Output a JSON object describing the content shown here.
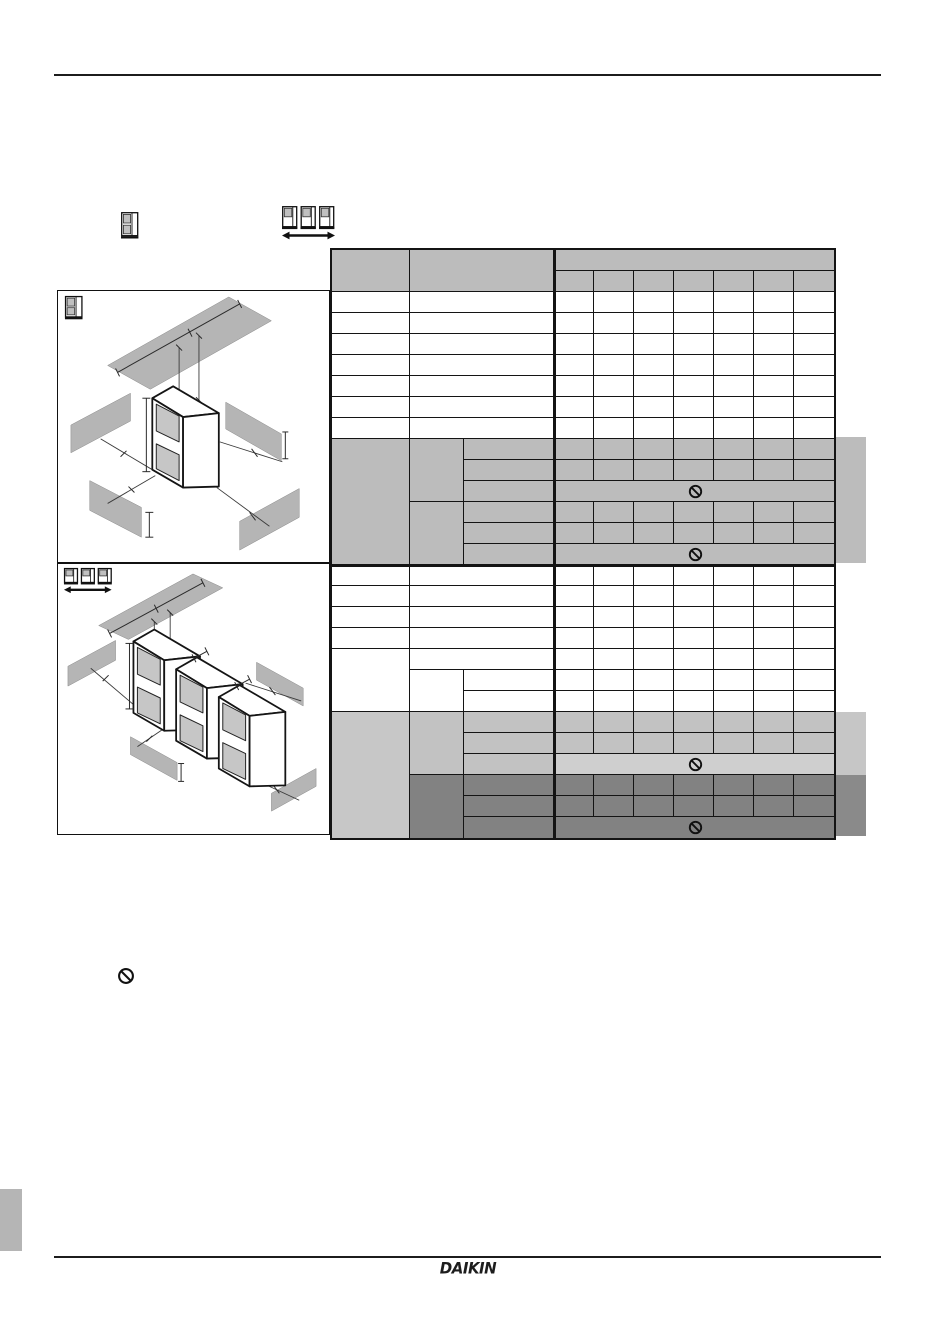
{
  "page": {
    "logo": "DAIKIN"
  },
  "legend": {
    "single_unit_icon": "single-outdoor-unit-front-view",
    "unit_row_icon": "three-outdoor-units-in-row-with-width-arrow"
  },
  "figure": {
    "block1": {
      "diagram": "isometric single outdoor unit with four surrounding walls and ceiling plane"
    },
    "block2": {
      "diagram": "isometric row of three outdoor units with four surrounding walls and ceiling plane"
    },
    "table": {
      "header_rows": 2,
      "left_columns": 3,
      "data_columns": 7,
      "all_cells_empty": true,
      "prohibition_symbol_rows": 4
    }
  },
  "symbols": {
    "prohibition": "circle-with-diagonal-slash"
  },
  "colors": {
    "table_gray": "#bcbcbc",
    "block2_light_gray": "#c2c2c2",
    "block2_lighter_gray": "#cfcfcf",
    "block2_dark_gray": "#828282",
    "wall_gray": "#b5b5b5",
    "side_tab_gray": "#bcbcbc",
    "side_tab_light": "#c6c6c6",
    "side_tab_dark": "#8a8a8a",
    "line": "#141414"
  }
}
